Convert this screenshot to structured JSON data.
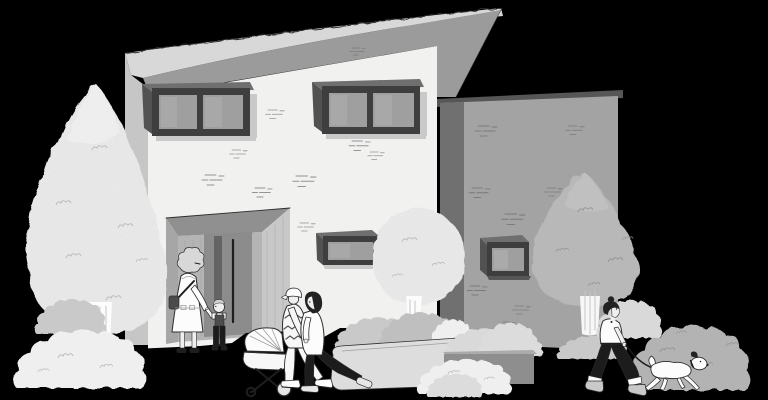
{
  "page": {
    "title": "House illustration",
    "description": "Black-and-white illustration of a modern flat-roof house with a slanted roof and gray annex wing. Trees and bushes surround the home. A grandmother holds a boy's hand by the recessed entrance, a couple pushes a baby stroller, and a person walks a small white dog on a leash."
  },
  "scene": {
    "elements": [
      {
        "name": "slanted-roof",
        "label": "Slanted overhanging roof"
      },
      {
        "name": "main-facade",
        "label": "Two-story white facade with brick marks"
      },
      {
        "name": "annex-wing",
        "label": "Gray single-story annex wing"
      },
      {
        "name": "entrance-recess",
        "label": "Recessed entrance with tall door and handle"
      },
      {
        "name": "upper-window-left",
        "label": "Upper double window, left"
      },
      {
        "name": "upper-window-right",
        "label": "Upper double window, right"
      },
      {
        "name": "ground-floor-window",
        "label": "Ground floor window"
      },
      {
        "name": "annex-window",
        "label": "Small annex window"
      },
      {
        "name": "tall-tree",
        "label": "Tall light conical tree"
      },
      {
        "name": "round-tree",
        "label": "Round light tree"
      },
      {
        "name": "gray-tree",
        "label": "Gray tree beside annex"
      },
      {
        "name": "planter",
        "label": "Curved planter wall with shrubs"
      },
      {
        "name": "ledge",
        "label": "Low ledge with shrubs"
      },
      {
        "name": "shrubs",
        "label": "Assorted bushes"
      },
      {
        "name": "grandmother",
        "label": "Grandmother holding the boy's hand"
      },
      {
        "name": "boy",
        "label": "Small boy in overalls"
      },
      {
        "name": "baby-stroller",
        "label": "Baby stroller"
      },
      {
        "name": "father",
        "label": "Father in patterned sweater pushing stroller"
      },
      {
        "name": "mother",
        "label": "Mother in white top pushing stroller"
      },
      {
        "name": "dog-walker",
        "label": "Person walking a dog"
      },
      {
        "name": "dog",
        "label": "Small white dog on leash"
      }
    ]
  },
  "palette": {
    "bg": "#000000",
    "ink": "#2e2e2e",
    "roof": "#d8d8d8",
    "fascia": "#9b9b9b",
    "leftwall": "#c6c6c6",
    "facade": "#f1f1ef",
    "annex": "#a3a3a3",
    "ashadow": "#707070",
    "parapet": "#565656",
    "frame": "#3e3e3e",
    "frametop": "#6f6f6f",
    "frameside": "#525252",
    "glass": "#9f9f9f",
    "glasshi": "#b2b2b2",
    "winshadow": "#c9c9c9",
    "ceil": "#909090",
    "back": "#b4b4b4",
    "side": "#c8c8c8",
    "jamb": "#a6a6a6",
    "door": "#8c8c8c",
    "slit": "#646464",
    "treelight": "#ededed",
    "treehi": "#f7f7f7",
    "treegray": "#b9b9b9",
    "treegrayhi": "#c9c9c9",
    "trunkline": "#c6c6c6",
    "bushlight": "#efefef",
    "bushlight2": "#d9d9d9",
    "bushmid": "#c9c9c9",
    "bushmid2": "#dcdcdc",
    "bushgray": "#b3b3b3",
    "bushgray2": "#bfbfbf",
    "planter": "#dddddd",
    "planterside": "#cfcfcf",
    "ledge": "#8e8e8e",
    "ledgetop": "#ababab",
    "brick": "#949494",
    "bricka": "#7b7b7b",
    "sql": "#bdbdbd",
    "sqg": "#979797",
    "white": "#fcfcfc",
    "offwhite": "#f7f7f7",
    "dark": "#1e1e1e",
    "skin": "#efefef",
    "hairgray": "#d8d8d8",
    "hair2": "#d2d2d2",
    "hairdark": "#222222",
    "bag": "#4a4a4a",
    "bib": "#4d4d4d",
    "pants": "#1c1c1c",
    "shoe": "#e6e6e6",
    "boot": "#c9c9c9",
    "zig": "#565656",
    "faint": "#9e9e9e",
    "leash": "#1a1a1a"
  }
}
